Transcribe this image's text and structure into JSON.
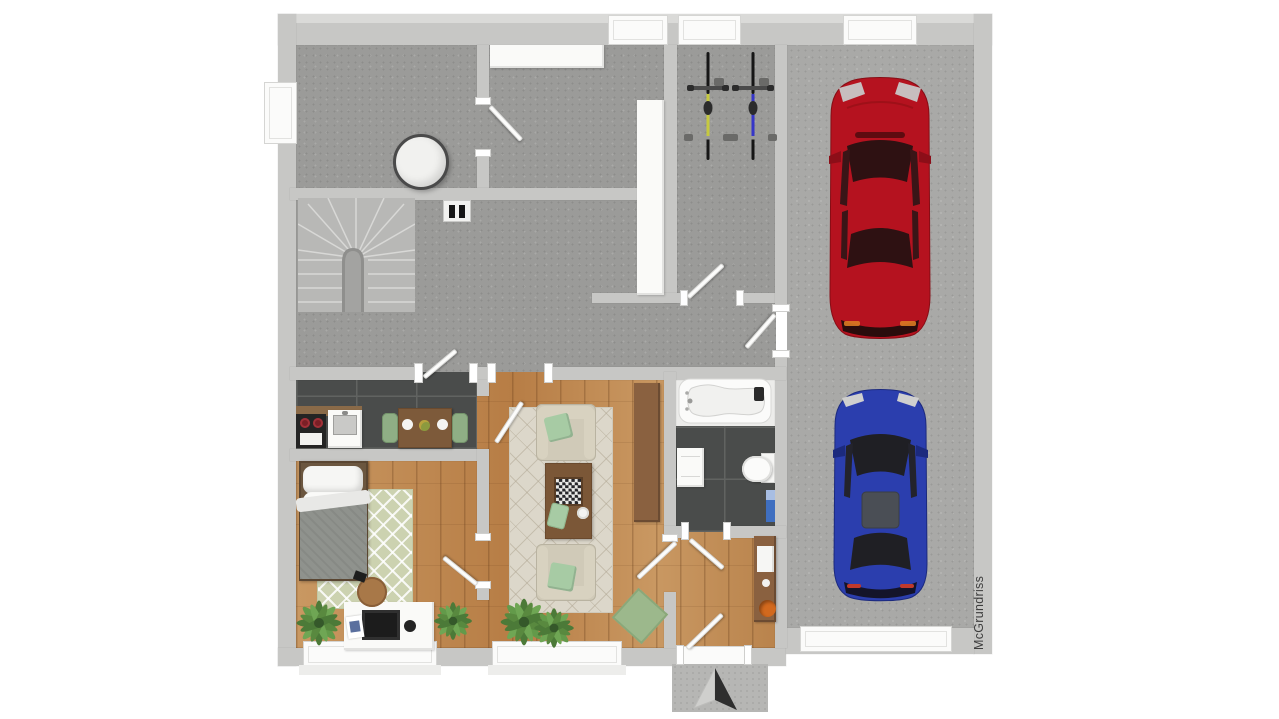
{
  "watermark": {
    "text": "McGrundriss"
  },
  "scene": {
    "description": "3D rendered ground-floor plan, top-down view, white background",
    "rooms": [
      {
        "name": "utility-room",
        "items": [
          "round white table"
        ]
      },
      {
        "name": "stair-hall",
        "items": [
          "u-shaped winder staircase",
          "double wall socket"
        ]
      },
      {
        "name": "corridor",
        "items": [
          "white wall shelf",
          "tall white cabinet"
        ]
      },
      {
        "name": "bicycle-storage",
        "items": [
          "yellow bicycle",
          "blue bicycle"
        ]
      },
      {
        "name": "garage",
        "items": [
          "red car",
          "blue car",
          "garage doors top and bottom"
        ]
      },
      {
        "name": "kitchen",
        "items": [
          "stove with red burners",
          "white sink unit",
          "wooden dining table",
          "two green chairs",
          "two white plates"
        ]
      },
      {
        "name": "living-room",
        "items": [
          "two beige armchairs with mint cushions",
          "wooden coffee table",
          "chessboard",
          "beige rug",
          "wooden sideboard",
          "potted plants",
          "green floor cushion"
        ]
      },
      {
        "name": "bedroom",
        "items": [
          "single bed with grey blanket",
          "patterned sage rug",
          "white desk with monitor",
          "wooden stool",
          "potted plants",
          "window"
        ]
      },
      {
        "name": "bathroom",
        "items": [
          "bathtub",
          "toilet",
          "white cabinet",
          "blue towel rail"
        ]
      },
      {
        "name": "entrance-hall",
        "items": [
          "wooden sideboard",
          "orange bowl",
          "front door",
          "entrance arrow marker"
        ]
      }
    ]
  },
  "colors": {
    "wall": "#c7c7c5",
    "roof-edge": "#dadad8",
    "concrete": "#9b9b99",
    "garage-floor": "#a9a9a7",
    "tile-dark": "#4a4c4b",
    "tile-grout": "#616361",
    "wood": "#c08a58",
    "wood-dark": "#8a6140",
    "rug-living": "#dcd7ca",
    "rug-bedroom": "#ccd2b0",
    "mint": "#a7cba4",
    "sofa-beige": "#d0cab8",
    "car-red": "#b5121f",
    "car-blue": "#2b3eae",
    "bike-yellow": "#c6c93f",
    "bike-blue": "#3636c8",
    "orange-accent": "#d2691e",
    "towel-blue": "#3f6fc0",
    "window-white": "#fbfbfa"
  }
}
